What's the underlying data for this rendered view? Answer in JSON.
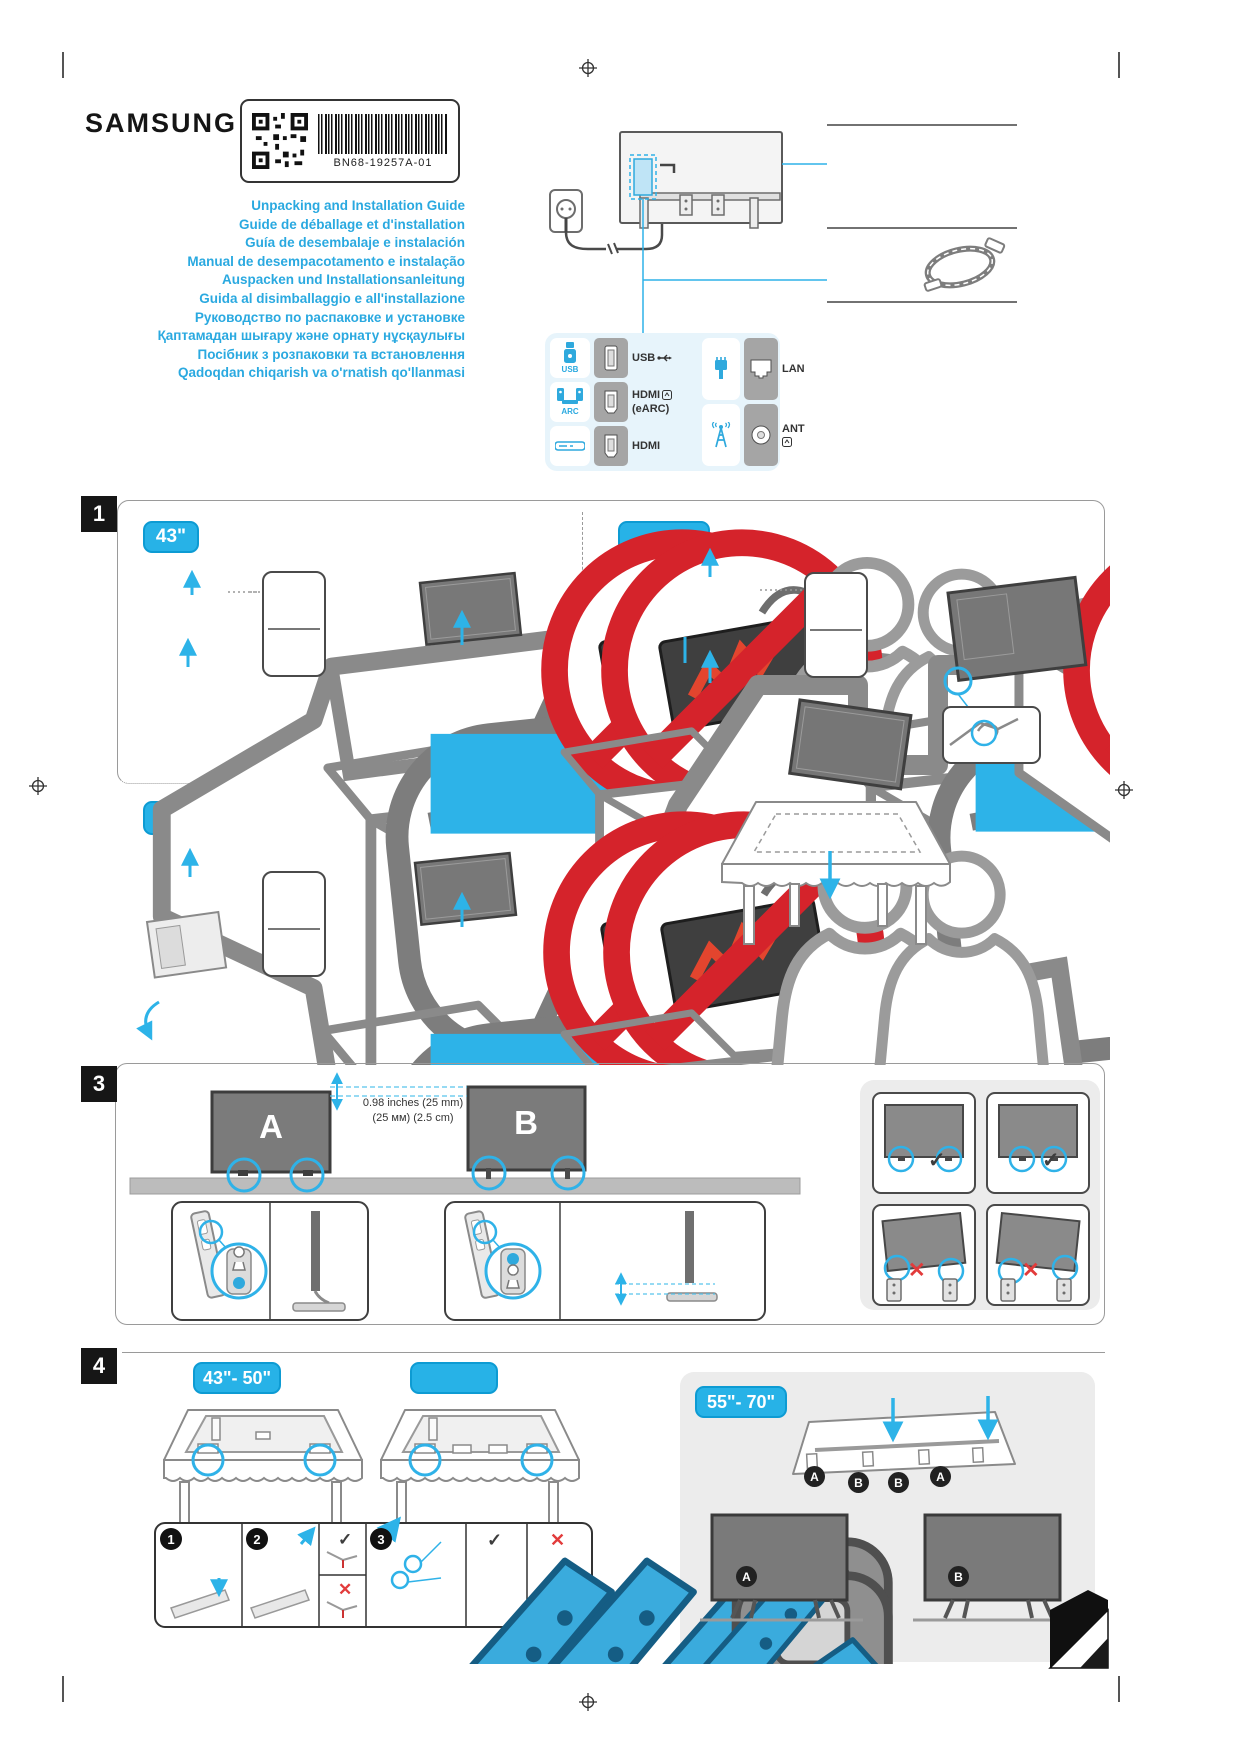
{
  "page": {
    "brand": "SAMSUNG",
    "part_code": "BN68-19257A-01",
    "titles": [
      "Unpacking and Installation Guide",
      "Guide de déballage et d'installation",
      "Guía de desembalaje e instalación",
      "Manual de desempacotamento e instalação",
      "Auspacken und Installationsanleitung",
      "Guida al disimballaggio e all'installazione",
      "Руководство по распаковке и установке",
      "Қаптамадан шығару және орнату нұсқаулығы",
      "Посібник з розпаковки та встановлення",
      "Qadoqdan chiqarish va o'rnatish qo'llanmasi"
    ]
  },
  "ports": {
    "usb_group_label": "USB",
    "arc_group_label": "ARC",
    "row_usb": "USB",
    "row_hdmi_earc_1": "HDMI",
    "row_hdmi_earc_2": "(eARC)",
    "row_hdmi": "HDMI",
    "row_lan": "LAN",
    "row_ant": "ANT"
  },
  "s1": {
    "number": "1",
    "size_left": "43\"",
    "size_right": "",
    "size_bottom": "50\"- 55\""
  },
  "s2": {
    "number": "2"
  },
  "s3": {
    "number": "3",
    "tv_a": "A",
    "tv_b": "B",
    "measure1": "0.98 inches (25 mm)",
    "measure2": "(25 мм) (2.5 cm)",
    "check": "✓",
    "cross": "✕"
  },
  "s4": {
    "number": "4",
    "size_left": "43\"- 50\"",
    "size_mid": "",
    "size_right": "55\"- 70\"",
    "step1": "1",
    "step2": "2",
    "step3": "3",
    "check": "✓",
    "cross": "✕",
    "m1": "A",
    "m2": "B",
    "m3": "B",
    "m4": "A",
    "tv_a": "A",
    "tv_b": "B"
  }
}
